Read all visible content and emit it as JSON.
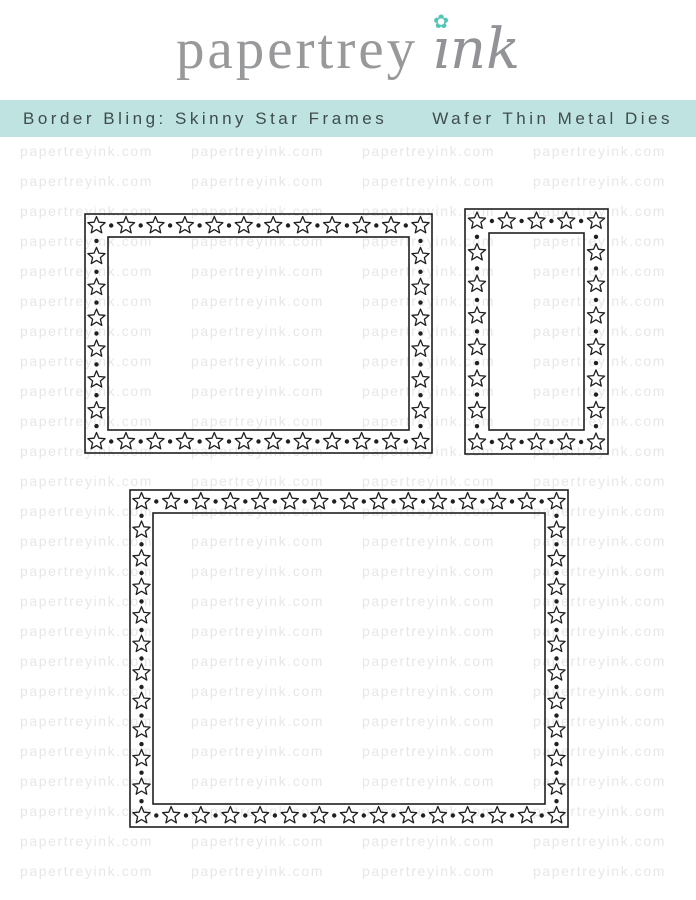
{
  "logo": {
    "brand_serif": "papertrey",
    "brand_script": "ınk",
    "flower_icon_glyph": "✿",
    "flower_color": "#54c3b8",
    "text_color": "#98999b"
  },
  "banner": {
    "left_text": "Border Bling: Skinny Star Frames",
    "right_text": "Wafer Thin Metal Dies",
    "bg_color": "#bee3e0",
    "text_color": "#3f4c4d"
  },
  "watermark": {
    "text": "papertreyink.com",
    "color": "#e7e7e7",
    "rows": 25,
    "per_row": 4,
    "row_height": 30,
    "start_y": 143,
    "start_x": 20,
    "col_width": 171
  },
  "dies": {
    "stroke_color": "#202020",
    "star_fill": "#ffffff",
    "star_radius": 9,
    "star_inner_ratio": 0.45,
    "dot_radius": 2.2,
    "frames": [
      {
        "name": "landscape-star-frame-die",
        "x": 85,
        "y": 214,
        "width": 347,
        "height": 239,
        "border": 23,
        "top_stars": 12,
        "side_stars": 6
      },
      {
        "name": "slim-vertical-star-frame-die",
        "x": 465,
        "y": 209,
        "width": 143,
        "height": 245,
        "border": 24,
        "top_stars": 5,
        "side_stars": 6
      },
      {
        "name": "large-square-star-frame-die",
        "x": 130,
        "y": 490,
        "width": 438,
        "height": 337,
        "border": 23,
        "top_stars": 15,
        "side_stars": 10
      }
    ]
  }
}
